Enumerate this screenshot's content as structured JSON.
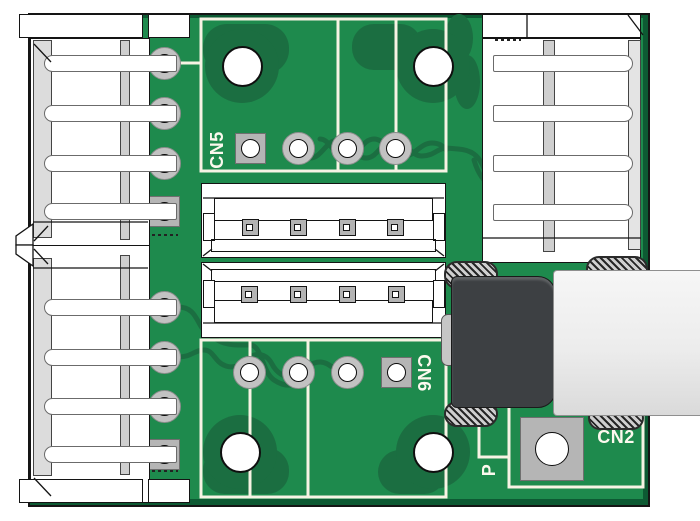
{
  "title": "PCB connector board render",
  "labels": {
    "cn5": "CN5",
    "cn6": "CN6",
    "cn2": "CN2",
    "p_partial": "P"
  },
  "colors": {
    "pcb_green": "#1e8a4d",
    "pcb_dark_plane": "#1b6e41",
    "board_edge": "#0d5a33",
    "silkscreen": "#f7f3e4",
    "pad_gray": "#c2c2c2",
    "connector_body": "#ffffff",
    "usb_body_gray": "#3d4043",
    "usb_shell": "#efefef",
    "label_white": "#fcf9ee"
  },
  "connectors": [
    {
      "id": "top-left-header",
      "type": "4-pin side-entry header",
      "pins": 4,
      "square_pad": "last"
    },
    {
      "id": "bottom-left-header",
      "type": "4-pin side-entry header",
      "pins": 4,
      "square_pad": "last"
    },
    {
      "id": "top-right-header",
      "type": "4-pin side-entry header",
      "pins": 4,
      "square_pad": "first"
    },
    {
      "id": "cn5",
      "label": "CN5",
      "type": "4-pad through-hole row",
      "pads": 4,
      "square_pad": "first"
    },
    {
      "id": "cn6",
      "label": "CN6",
      "type": "4-pad through-hole row",
      "pads": 4,
      "square_pad": "last"
    },
    {
      "id": "top-middle-header",
      "type": "4-pin header top view",
      "pins": 4
    },
    {
      "id": "bottom-middle-header",
      "type": "4-pin header top view",
      "pins": 4
    },
    {
      "id": "cn2",
      "label": "CN2",
      "type": "USB connector with shield",
      "mounting_tabs": 4
    }
  ],
  "mounting_holes": 4
}
